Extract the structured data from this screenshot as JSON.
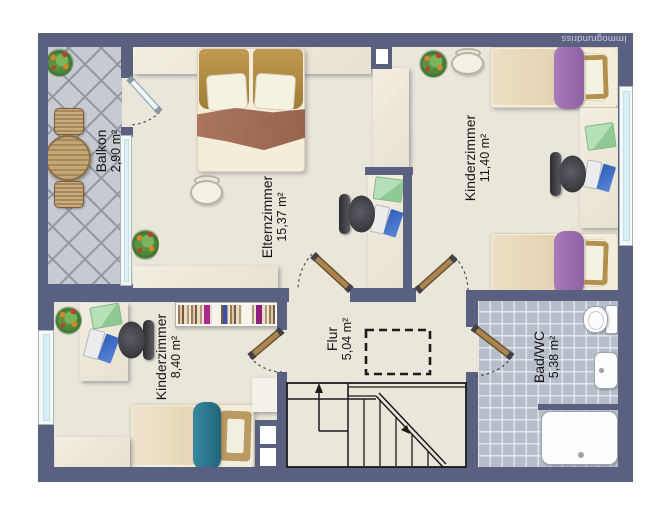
{
  "watermark": "Immogrundriss",
  "rooms": [
    {
      "name": "Balkon",
      "area": "2,90 m²"
    },
    {
      "name": "Elternzimmer",
      "area": "15,37 m²"
    },
    {
      "name": "Kinderzimmer",
      "area": "11,40 m²"
    },
    {
      "name": "Kinderzimmer",
      "area": "8,40 m²"
    },
    {
      "name": "Flur",
      "area": "5,04 m²"
    },
    {
      "name": "Bad/WC",
      "area": "5,38 m²"
    }
  ],
  "colors": {
    "wall": "#5a6180",
    "floor": "#eae6da",
    "balcony_tile": "#c7cbd1",
    "bath_tile": "#b6bec9",
    "window_glass": "#d8f1f7",
    "door_wood": "#ab8650",
    "accent_purple": "#9b70af",
    "accent_teal": "#2b7a8e",
    "green_pad": "#a7d6aa",
    "laptop_blue": "#3a6cc8",
    "bed_cream": "#f3edda",
    "blanket_brown": "#a5705a",
    "headboard_gold": "#b3914c"
  }
}
